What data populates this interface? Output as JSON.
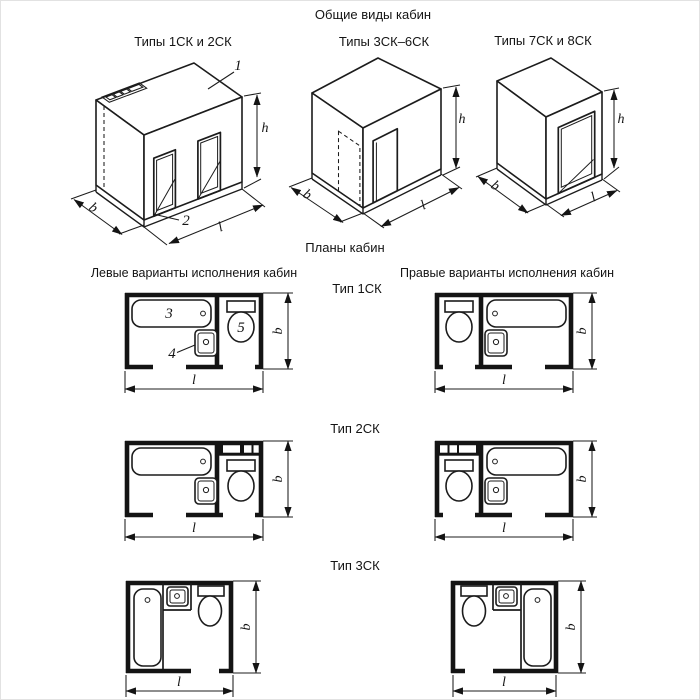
{
  "drawing": {
    "title": "Общие виды кабин",
    "plans_section_title": "Планы кабин",
    "columns": {
      "left": "Левые варианты исполнения кабин",
      "right": "Правые варианты исполнения кабин"
    },
    "views": [
      {
        "label": "Типы 1СК и 2СК"
      },
      {
        "label": "Типы 3СК–6СК"
      },
      {
        "label": "Типы 7СК и 8СК"
      }
    ],
    "plan_rows": [
      {
        "label": "Тип 1СК"
      },
      {
        "label": "Тип 2СК"
      },
      {
        "label": "Тип 3СК"
      }
    ],
    "callouts": {
      "ceiling_panel": "1",
      "base_frame": "2",
      "bathtub": "3",
      "washbasin": "4",
      "toilet": "5"
    },
    "dim": {
      "b": "b",
      "l": "l",
      "h": "h"
    },
    "colors": {
      "line": "#1c1c1c",
      "background": "#ffffff"
    }
  }
}
